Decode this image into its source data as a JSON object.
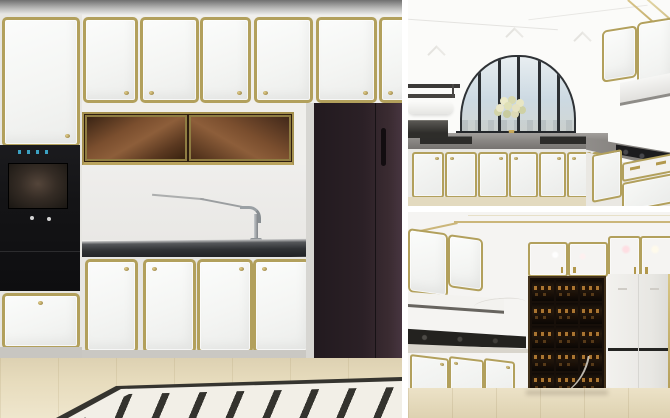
{
  "meta": {
    "description": "Collage of three photorealistic kitchen interior renders: white cabinetry with gold trim, built-in black oven column, bronze glass wall cabinets, dark refrigerator, arched window kitchen, and a backlit wine cabinet",
    "width": 670,
    "height": 418
  },
  "palette": {
    "gold": "#b2a05c",
    "gold_bright": "#d8c489",
    "wall": "#f0efec",
    "counter_dark": "#2f3134",
    "oven_black": "#141416",
    "fridge": "#2b2026",
    "glass_brown": "#7a4e2c",
    "glass_brown_dark": "#3c2514",
    "floor": "#e7dcbd",
    "inlay_line": "#35342f",
    "inlay_field": "#f2efe7",
    "sky": "#ccd9e2",
    "window_frame": "#2e3236",
    "wine_case": "#170f09",
    "wine_glow": "#b07a33",
    "steel": "#9aa0a4",
    "shelf_dark": "#3b3937"
  },
  "panels": {
    "left": {
      "upper_door_count": 6,
      "base_door_count": 4,
      "appliances": [
        "built-in-oven",
        "bronze-glass-cabinet",
        "refrigerator"
      ]
    },
    "top_right": {
      "features": [
        "arched-window",
        "flower-vase",
        "open-shelves",
        "range-hood",
        "gas-cooktop"
      ]
    },
    "bottom_right": {
      "wine_cabinet": {
        "rows": 5,
        "cols": 3
      },
      "features": [
        "glass-upper-cabinets",
        "white-fridge-unit",
        "cooktop-counter"
      ]
    }
  }
}
